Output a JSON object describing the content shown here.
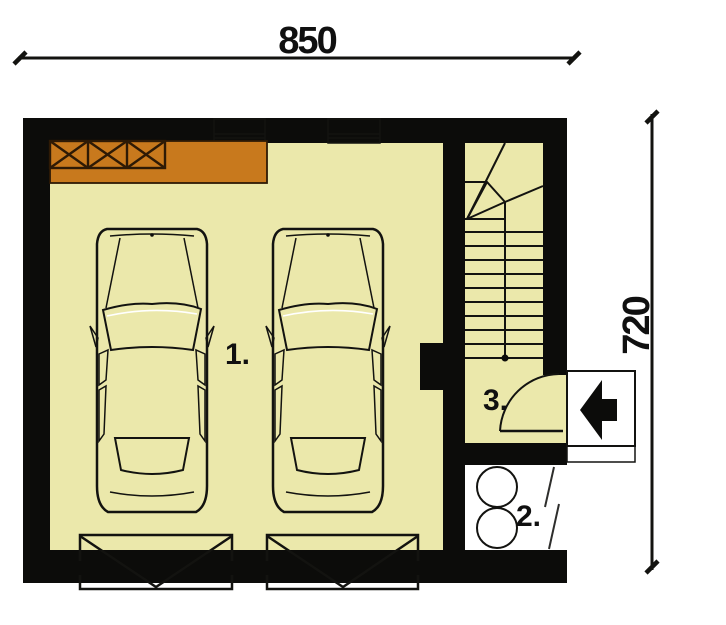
{
  "dimensions": {
    "width_label": "850",
    "height_label": "720"
  },
  "rooms": {
    "garage": {
      "label": "1."
    },
    "boiler_room": {
      "label": "2."
    },
    "entry_hall": {
      "label": "3."
    }
  },
  "icons": {
    "entry_arrow": "left-arrow",
    "stair_walk_line": "dot-start-line",
    "garage_door": "v-fold-panel",
    "shelf": "x-crossed-rack"
  },
  "colors": {
    "wall": "#0c0c0a",
    "floor": "#ebe8ab",
    "boiler_floor": "#ffffff",
    "workbench": "#c8791d",
    "workbench_outline": "#2e1a05",
    "car_body": "#8b9270",
    "car_glass": "#dde9ef",
    "car_mirror": "#d8dde0",
    "garage_door": "#d7d7d5",
    "entry_box": "#dcdcda",
    "boiler_tank": "#d2d2d0",
    "window_glass": "#e9f0f4",
    "line": "#131310"
  }
}
